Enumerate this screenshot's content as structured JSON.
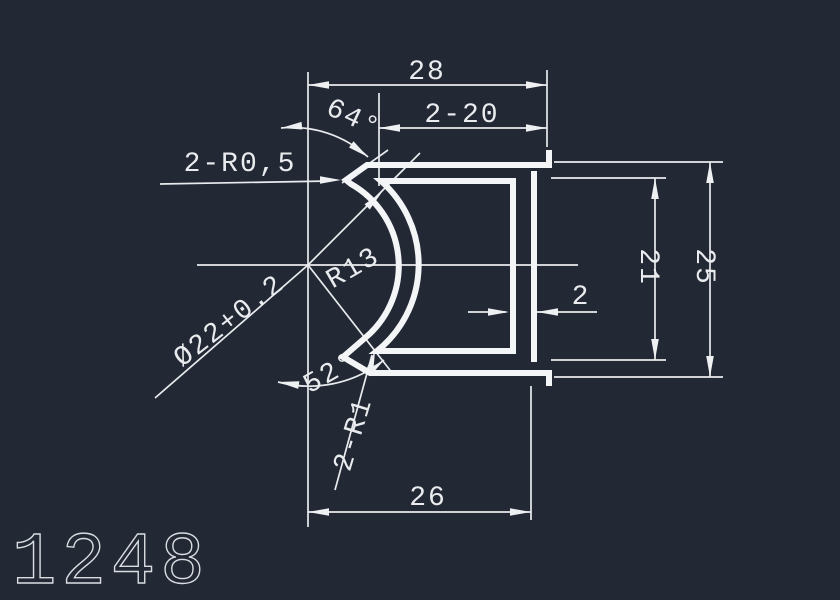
{
  "canvas": {
    "background": "#222834",
    "geometry_color": "#f4f5f7",
    "dimension_color": "#e9ebee"
  },
  "part": {
    "number": "1248"
  },
  "dims": {
    "overall_width": "28",
    "flange_length": "2-20",
    "top_angle": "64°",
    "top_lip_radius": "2-R0,5",
    "outer_radius": "R13",
    "bore": "Ø22+0.2",
    "bottom_angle": "52°",
    "bottom_lip_radius": "2-R1",
    "wall_thickness": "2",
    "inner_height": "21",
    "overall_height": "25",
    "bottom_width": "26"
  }
}
